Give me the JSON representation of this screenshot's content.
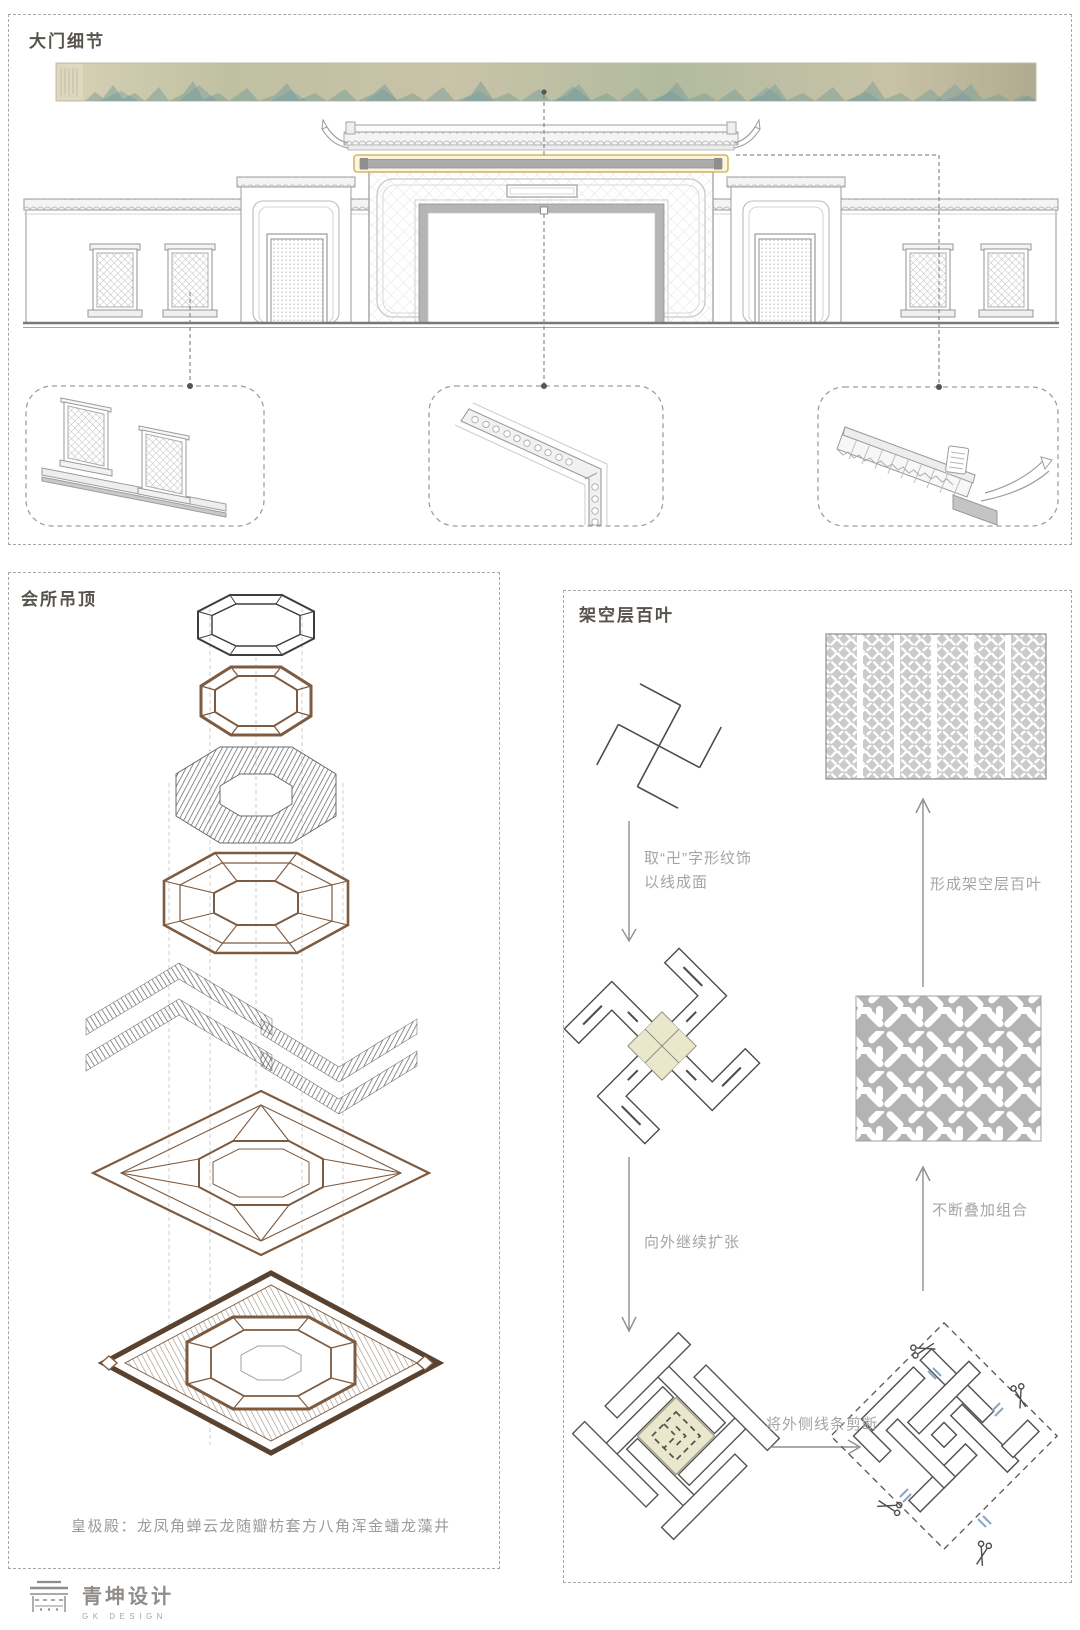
{
  "sections": {
    "gate": {
      "title": "大门细节"
    },
    "ceiling": {
      "title": "会所吊顶",
      "caption": "皇极殿：龙凤角蝉云龙随瓣枋套方八角浑金蟠龙藻井"
    },
    "louver": {
      "title": "架空层百叶",
      "labels": {
        "step1_line1": "取“卍”字形纹饰",
        "step1_line2": "以线成面",
        "step2": "向外继续扩张",
        "step3": "将外侧线条剪断",
        "step4": "不断叠加组合",
        "step5": "形成架空层百叶"
      }
    }
  },
  "logo": {
    "name": "青坤设计",
    "sub": "GK DESIGN"
  },
  "colors": {
    "highlight_gold": "#d3b964",
    "olive_fill": "#e9e7cc",
    "wood_brown": "#7d5b41",
    "dark_frame": "#5a422e",
    "line_dark": "#4e4c49",
    "label_gray": "#a5a5a5",
    "border_gray": "#a7a7a7",
    "cut_mark_blue": "#8aa5c4"
  }
}
